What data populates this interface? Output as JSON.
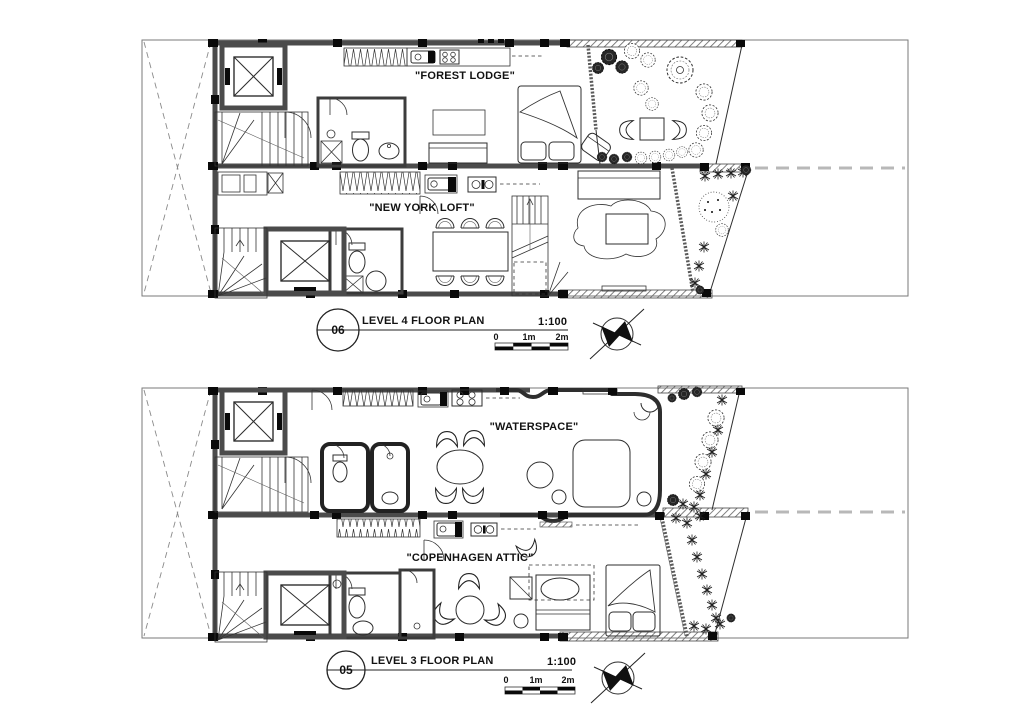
{
  "colors": {
    "background": "#ffffff",
    "line": "#1f1f1f",
    "wall": "#4b4b4b",
    "property_dash": "#b8b8b8"
  },
  "icons": {
    "north_arrow": "north-arrow-compass",
    "elevator": "elevator-x-symbol",
    "stairs": "stair-treads"
  },
  "plans": {
    "level4": {
      "units": {
        "a": "\"FOREST LODGE\"",
        "b": "\"NEW YORK LOFT\""
      },
      "title": {
        "number": "06",
        "name": "LEVEL 4 FLOOR PLAN",
        "scale": "1:100"
      },
      "scalebar": {
        "l0": "0",
        "l1": "1m",
        "l2": "2m"
      }
    },
    "level3": {
      "units": {
        "a": "\"WATERSPACE\"",
        "b": "\"COPENHAGEN ATTIC\""
      },
      "title": {
        "number": "05",
        "name": "LEVEL 3 FLOOR PLAN",
        "scale": "1:100"
      },
      "scalebar": {
        "l0": "0",
        "l1": "1m",
        "l2": "2m"
      }
    }
  }
}
